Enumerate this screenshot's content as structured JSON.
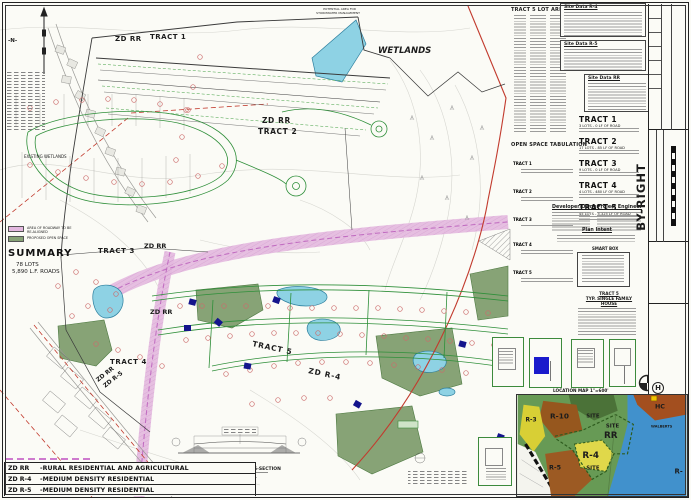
{
  "sheet": {
    "sheet_number": "01 - 01",
    "project_number": "4663/2023",
    "title_vertical": "BY-RIGHT",
    "plan_type": "SKETCH PLAN",
    "subdivision_name": "BLUE BARN SUBDIVISION",
    "township": "NORTH WHITEHALL TOWNSHIP",
    "county": "LEHIGH COUNTY",
    "state": "PENNSYLVANIA",
    "firm": "HanoverEngineering"
  },
  "plan_labels": {
    "north": "-N-",
    "wetlands": "WETLANDS",
    "existing_wetlands": "EXISTING WETLANDS",
    "stormwater_line1": "POTENTIAL AREA FOR",
    "stormwater_line2": "STORMWATER MANAGEMENT",
    "tract1_zone": "ZD RR",
    "tract1": "TRACT 1",
    "tract2_zone": "ZD RR",
    "tract2": "TRACT 2",
    "tract3": "TRACT 3",
    "tract3_zone": "ZD RR",
    "center_zone": "ZD RR",
    "tract4": "TRACT 4",
    "split_zone_rr": "ZD RR",
    "split_zone_r5": "ZD R-5",
    "tract5": "TRACT 5",
    "tract5_zone": "ZD R-4"
  },
  "swatch_legend": {
    "realign_line1": "AREA OF ROADWAY TO BE",
    "realign_line2": "RE-ALIGNED",
    "open_space": "PROPOSED OPEN SPACE"
  },
  "summary": {
    "title": "SUMMARY",
    "lots": "78 LOTS",
    "roads": "5,890 L.F. ROADS"
  },
  "zoning_legend": {
    "rows": [
      {
        "code": "ZD RR",
        "desc": "-RURAL RESIDENTIAL AND AGRICULTURAL"
      },
      {
        "code": "ZD R-4",
        "desc": "-MEDIUM DENSITY RESIDENTIAL"
      },
      {
        "code": "ZD R-5",
        "desc": "-MEDIUM DENSITY RESIDENTIAL"
      }
    ]
  },
  "details": {
    "cross_section_caption": "TYPICAL STREET CROSS-SECTION",
    "house_detail_line1": "TRACT 5",
    "house_detail_line2": "TYP. SINGLE FAMILY HOUSE",
    "smart_box": "SMART BOX",
    "location_map_caption": "LOCATION MAP  1\"=600'"
  },
  "panel": {
    "lot_areas_title": "TRACT 5 LOT AREAS",
    "site_data_r4": "Site Data  R-4",
    "site_data_r5": "Site Data  R-5",
    "site_data_rr": "Site Data  RR",
    "open_space_title": "OPEN SPACE TABULATION",
    "open_space_rows": [
      {
        "name": "TRACT 1"
      },
      {
        "name": "TRACT 2"
      },
      {
        "name": "TRACT 3"
      },
      {
        "name": "TRACT 4"
      },
      {
        "name": "TRACT 5"
      }
    ],
    "tract_stats": [
      {
        "name": "TRACT 1",
        "stats": "3 LOTS - 0 LF OF ROAD"
      },
      {
        "name": "TRACT 2",
        "stats": "17 LOTS - 85 LF OF ROAD"
      },
      {
        "name": "TRACT 3",
        "stats": "9 LOTS - 0 LF OF ROAD"
      },
      {
        "name": "TRACT 4",
        "stats": "4 LOTS - 480 LF OF ROAD"
      },
      {
        "name": "TRACT 5",
        "stats": "45 LOTS - 5,325 LF OF ROAD"
      }
    ],
    "developer_title": "Developer/Owner",
    "engineer_title": "Project Engineer",
    "plan_intent_title": "Plan Intent"
  },
  "location_map": {
    "labels": {
      "r3": "R-3",
      "r10": "R-10",
      "site_a": "SITE",
      "site_b": "SITE",
      "rr": "RR",
      "r4": "R-4",
      "site_c": "SITE",
      "r5": "R-5",
      "hc": "HC",
      "walberts": "WALBERTS",
      "r_clip": "R-"
    }
  },
  "colors": {
    "open_space": "#87a376",
    "pond": "#8ed2e4",
    "realign_corridor": "#e3b8df",
    "road_green": "#2f8f3a",
    "boundary_red": "#c23b2e",
    "house_navy": "#14148c",
    "map_green": "#679a55",
    "map_brown": "#96571e",
    "map_yellow": "#ddd23f",
    "map_blue": "#4191cc"
  }
}
